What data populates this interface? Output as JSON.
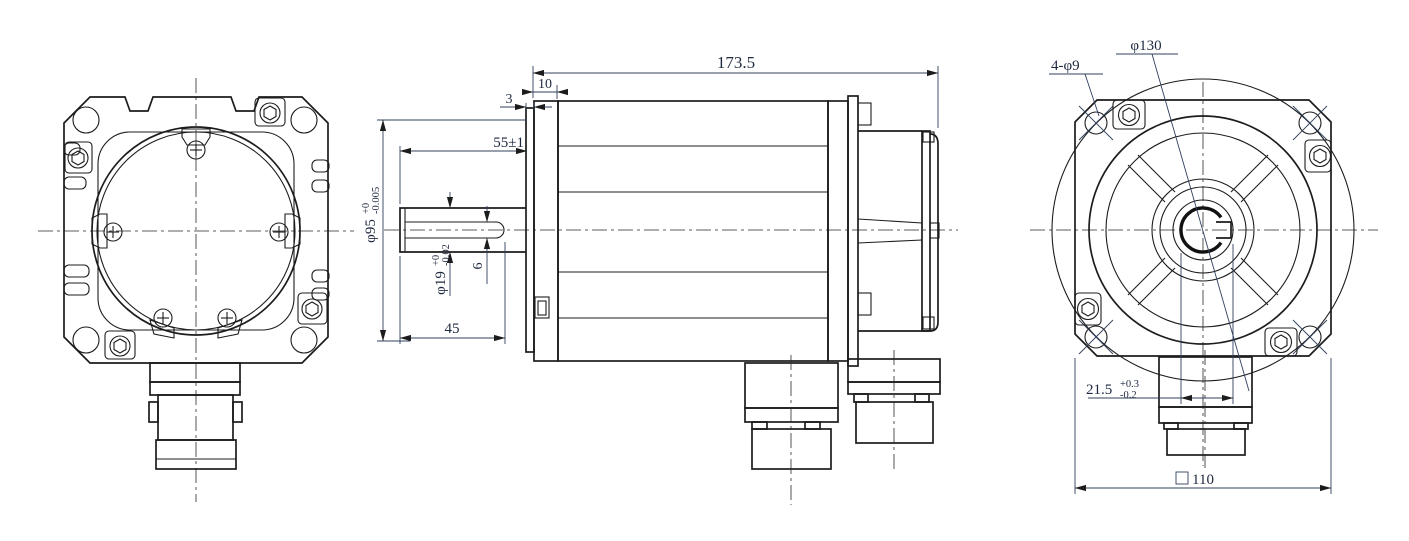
{
  "drawing": {
    "kind": "servo-motor-outline-dimension-drawing",
    "views": {
      "left": "rear-view",
      "middle": "side-view",
      "right": "front-flange-view"
    }
  },
  "dimensions": {
    "overall_length": "173.5",
    "pilot_depth": "10",
    "flange_thickness": "3",
    "shaft_extension": "55±1",
    "pilot_diameter": {
      "value": "φ95",
      "upper": "+0",
      "lower": "-0.005"
    },
    "shaft_diameter": {
      "value": "φ19",
      "upper": "+0",
      "lower": "-0.02"
    },
    "keyway_width": "6",
    "keyway_length": "45",
    "mounting_holes": "4-φ9",
    "bolt_circle_diameter": "φ130",
    "key_height": {
      "value": "21.5",
      "upper": "+0.3",
      "lower": "-0.2"
    },
    "flange_square": {
      "symbol": "□",
      "value": "110"
    }
  },
  "colors": {
    "line": "#1c1c1c",
    "dimension_text": "#1e2940",
    "background": "#ffffff"
  }
}
